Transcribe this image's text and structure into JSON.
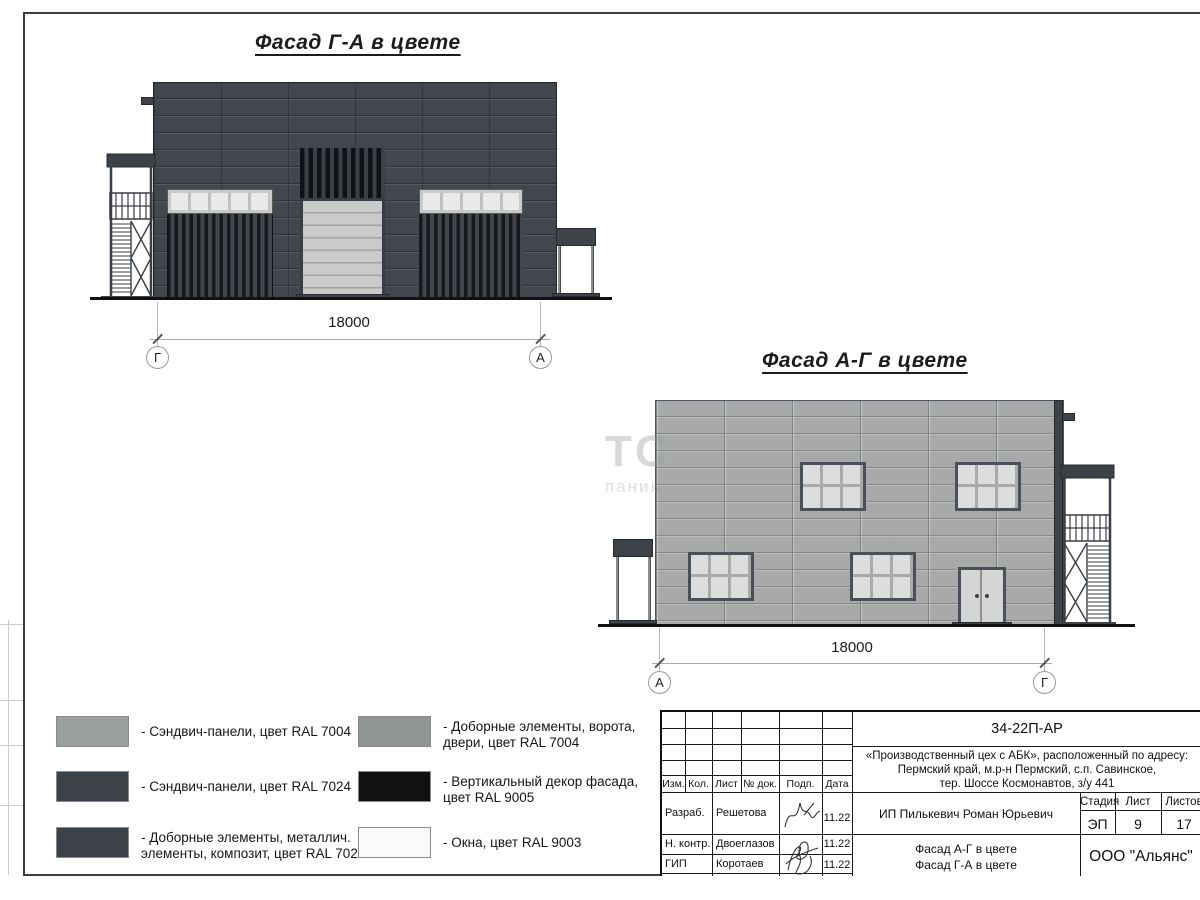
{
  "titles": {
    "facade_ga": "Фасад Г-А в цвете",
    "facade_ag": "Фасад А-Г в цвете"
  },
  "facade_ga": {
    "dim": "18000",
    "axis_left": "Г",
    "axis_right": "А"
  },
  "facade_ag": {
    "dim": "18000",
    "axis_left": "А",
    "axis_right": "Г"
  },
  "watermark": {
    "line1": "ТС",
    "line2": "пания"
  },
  "legend": {
    "items": [
      {
        "color": "#9ba09d",
        "label_lines": [
          "- Сэндвич-панели, цвет RAL 7004",
          ""
        ]
      },
      {
        "color": "#3c4248",
        "label_lines": [
          "- Сэндвич-панели, цвет RAL 7024",
          ""
        ]
      },
      {
        "color": "#3c4248",
        "label_lines": [
          "- Доборные элементы, металлич.",
          "элементы, композит, цвет RAL 7024"
        ]
      },
      {
        "color": "#8f9593",
        "label_lines": [
          "- Доборные элементы, ворота,",
          "двери, цвет RAL 7004"
        ]
      },
      {
        "color": "#101113",
        "label_lines": [
          "- Вертикальный декор фасада,",
          "цвет RAL 9005"
        ]
      },
      {
        "color": "#fafafa",
        "label_lines": [
          "- Окна, цвет RAL 9003",
          ""
        ]
      }
    ]
  },
  "title_block": {
    "doc_number": "34-22П-АР",
    "project_lines": [
      "«Производственный цех с АБК», расположенный по адресу:",
      "Пермский край, м.р-н Пермский, с.п. Савинское,",
      "тер. Шоссе Космонавтов, з/у 441"
    ],
    "columns": {
      "izm": "Изм.",
      "kol": "Кол.",
      "list": "Лист",
      "doc": "№ док.",
      "sign": "Подп.",
      "date": "Дата"
    },
    "rows": [
      {
        "role": "Разраб.",
        "name": "Решетова",
        "date": "11.22"
      },
      {
        "role": "Н. контр.",
        "name": "Двоеглазов",
        "date": "11.22"
      },
      {
        "role": "ГИП",
        "name": "Коротаев",
        "date": "11.22"
      }
    ],
    "client": "ИП Пилькевич Роман Юрьевич",
    "stage_label": "Стадия",
    "sheet_label": "Лист",
    "sheets_label": "Листов",
    "stage": "ЭП",
    "sheet": "9",
    "sheets": "17",
    "sheet_title_lines": [
      "Фасад А-Г в цвете",
      "Фасад Г-А в цвете"
    ],
    "company": "ООО \"Альянс\""
  }
}
